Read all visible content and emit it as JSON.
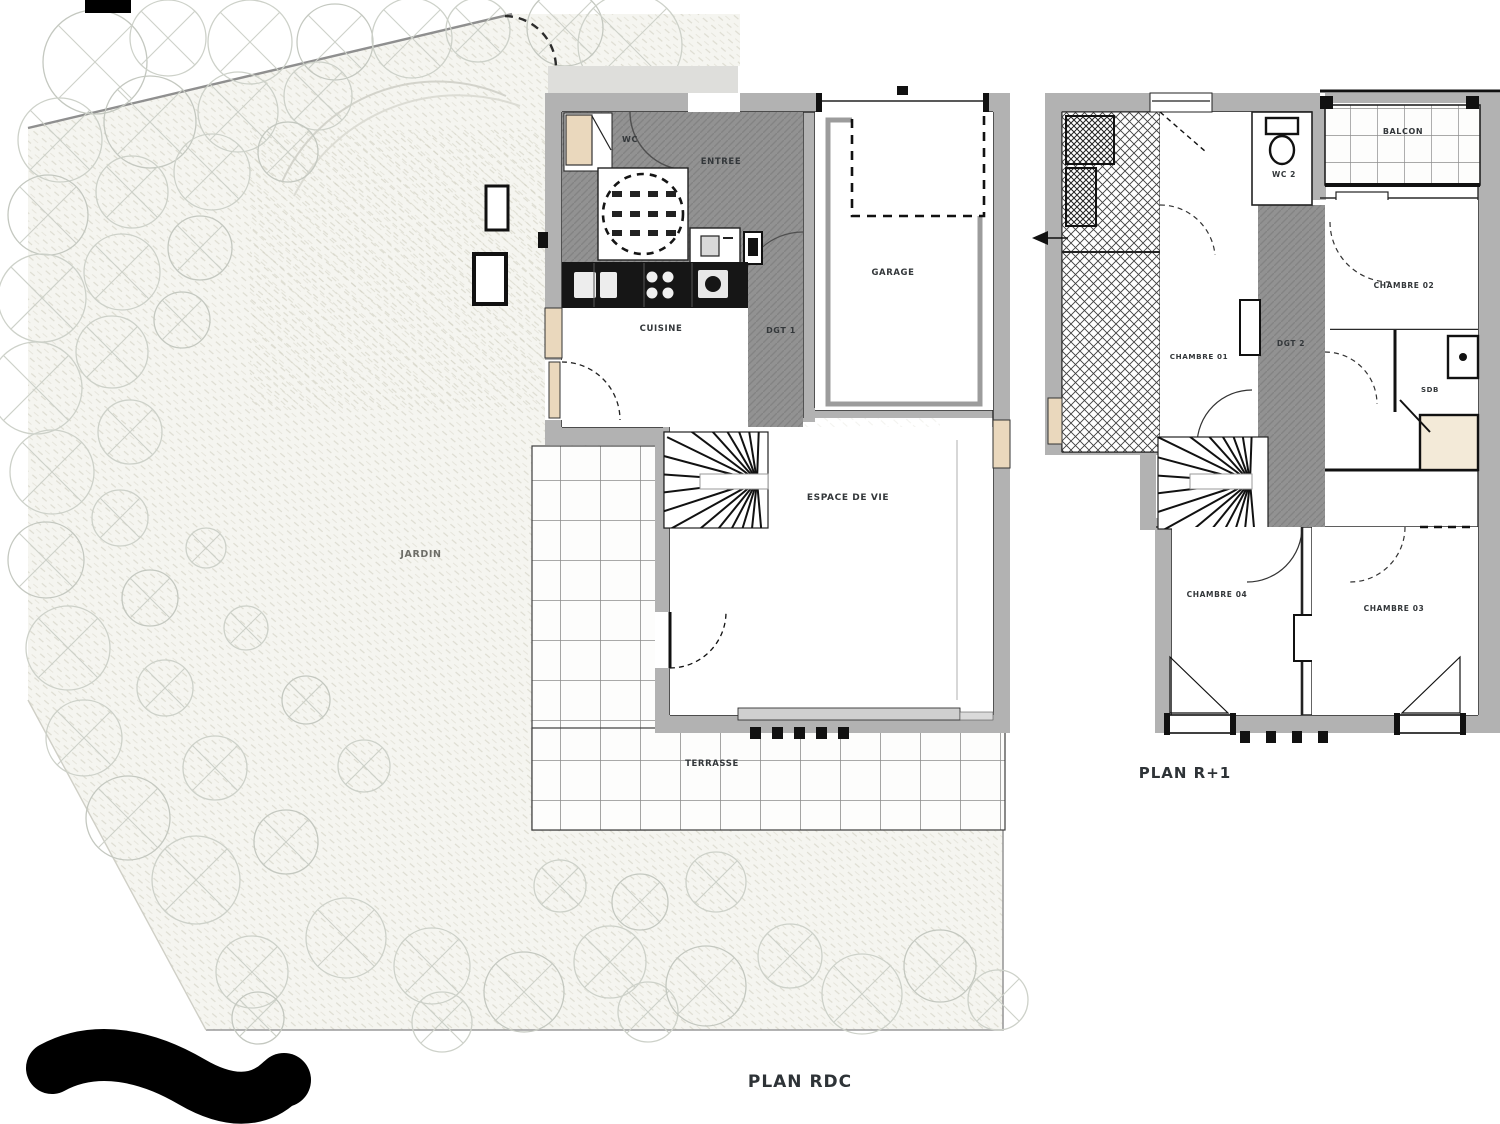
{
  "document": {
    "type": "architect-floor-plan",
    "plans": {
      "rdc": {
        "title": "PLAN RDC",
        "rooms": {
          "wc": "WC",
          "entree": "ENTREE",
          "garage": "GARAGE",
          "cuisine": "CUISINE",
          "dgt1": "DGT 1",
          "espace_de_vie": "ESPACE DE VIE",
          "terrasse": "TERRASSE",
          "jardin": "JARDIN"
        }
      },
      "r1": {
        "title": "PLAN R+1",
        "rooms": {
          "wc2": "WC 2",
          "balcon": "BALCON",
          "chambre01": "CHAMBRE 01",
          "chambre02": "CHAMBRE 02",
          "dgt2": "DGT 2",
          "sdb": "SDB",
          "chambre04": "CHAMBRE 04",
          "chambre03": "CHAMBRE 03"
        }
      }
    },
    "colors": {
      "wall_gray": "#b2b2b2",
      "circulation_gray": "#929292",
      "counter_black": "#161616",
      "tile_line": "#8d8d8d",
      "tree_line": "#c9cdc5",
      "label": "#33373a",
      "window_beige": "#ead8bd"
    }
  }
}
